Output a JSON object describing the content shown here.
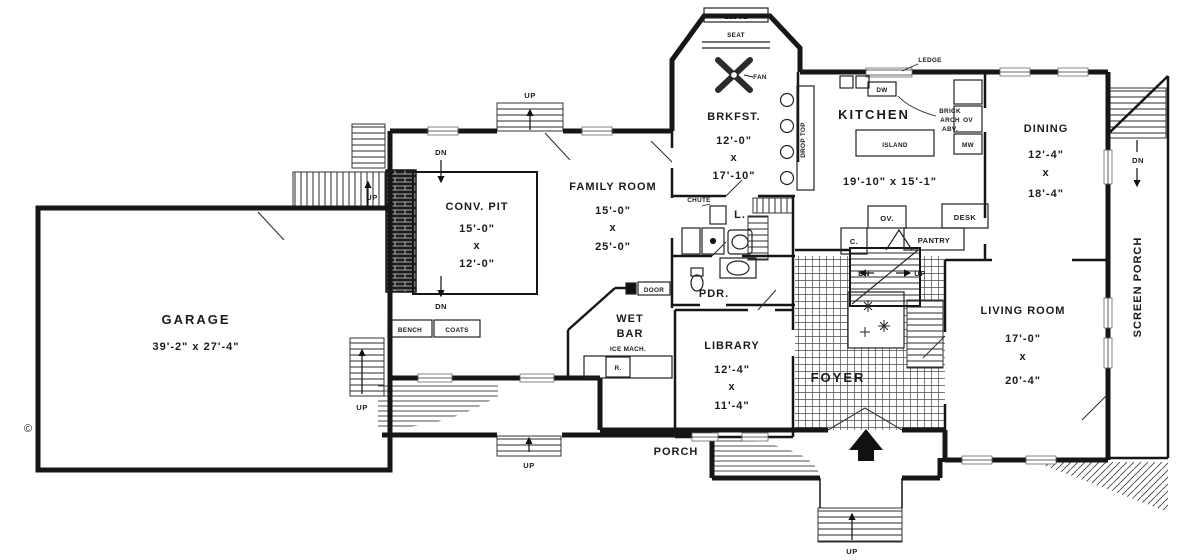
{
  "colors": {
    "ink": "#1b1b1b",
    "paper": "#ffffff"
  },
  "rooms": {
    "garage": {
      "name": "GARAGE",
      "dims": "39'-2\" x 27'-4\""
    },
    "conv_pit": {
      "name": "CONV. PIT",
      "d1": "15'-0\"",
      "sep": "x",
      "d2": "12'-0\""
    },
    "family": {
      "name": "FAMILY ROOM",
      "d1": "15'-0\"",
      "sep": "x",
      "d2": "25'-0\""
    },
    "brkfst": {
      "name": "BRKFST.",
      "d1": "12'-0\"",
      "sep": "x",
      "d2": "17'-10\""
    },
    "kitchen": {
      "name": "KITCHEN",
      "dims": "19'-10\" x 15'-1\""
    },
    "dining": {
      "name": "DINING",
      "d1": "12'-4\"",
      "sep": "x",
      "d2": "18'-4\""
    },
    "living": {
      "name": "LIVING ROOM",
      "d1": "17'-0\"",
      "sep": "x",
      "d2": "20'-4\""
    },
    "library": {
      "name": "LIBRARY",
      "d1": "12'-4\"",
      "sep": "x",
      "d2": "11'-4\""
    },
    "wet_bar": {
      "line1": "WET",
      "line2": "BAR"
    },
    "pdr": {
      "name": "PDR."
    },
    "laundry": {
      "name": "L."
    },
    "foyer": {
      "name": "FOYER"
    },
    "porch": {
      "name": "PORCH"
    },
    "screen_porch": {
      "name": "SCREEN PORCH"
    }
  },
  "features": {
    "ledge_bay": "LEDGE",
    "seat": "SEAT",
    "fan": "FAN",
    "ledge_kitchen": "LEDGE",
    "dw": "DW",
    "island": "ISLAND",
    "brick_arch_1": "BRICK",
    "brick_arch_2": "ARCH",
    "brick_arch_3": "ABV.",
    "ov_wall": "OV",
    "mw": "MW",
    "drop_top": "DROP TOP",
    "c_closet": "C.",
    "oven": "OV.",
    "pantry": "PANTRY",
    "desk": "DESK",
    "chute": "CHUTE",
    "door": "DOOR",
    "ice_mach": "ICE MACH.",
    "refrig": "R.",
    "bench": "BENCH",
    "coats": "COATS",
    "copyright": "©"
  },
  "directions": {
    "up": "UP",
    "dn": "DN"
  }
}
